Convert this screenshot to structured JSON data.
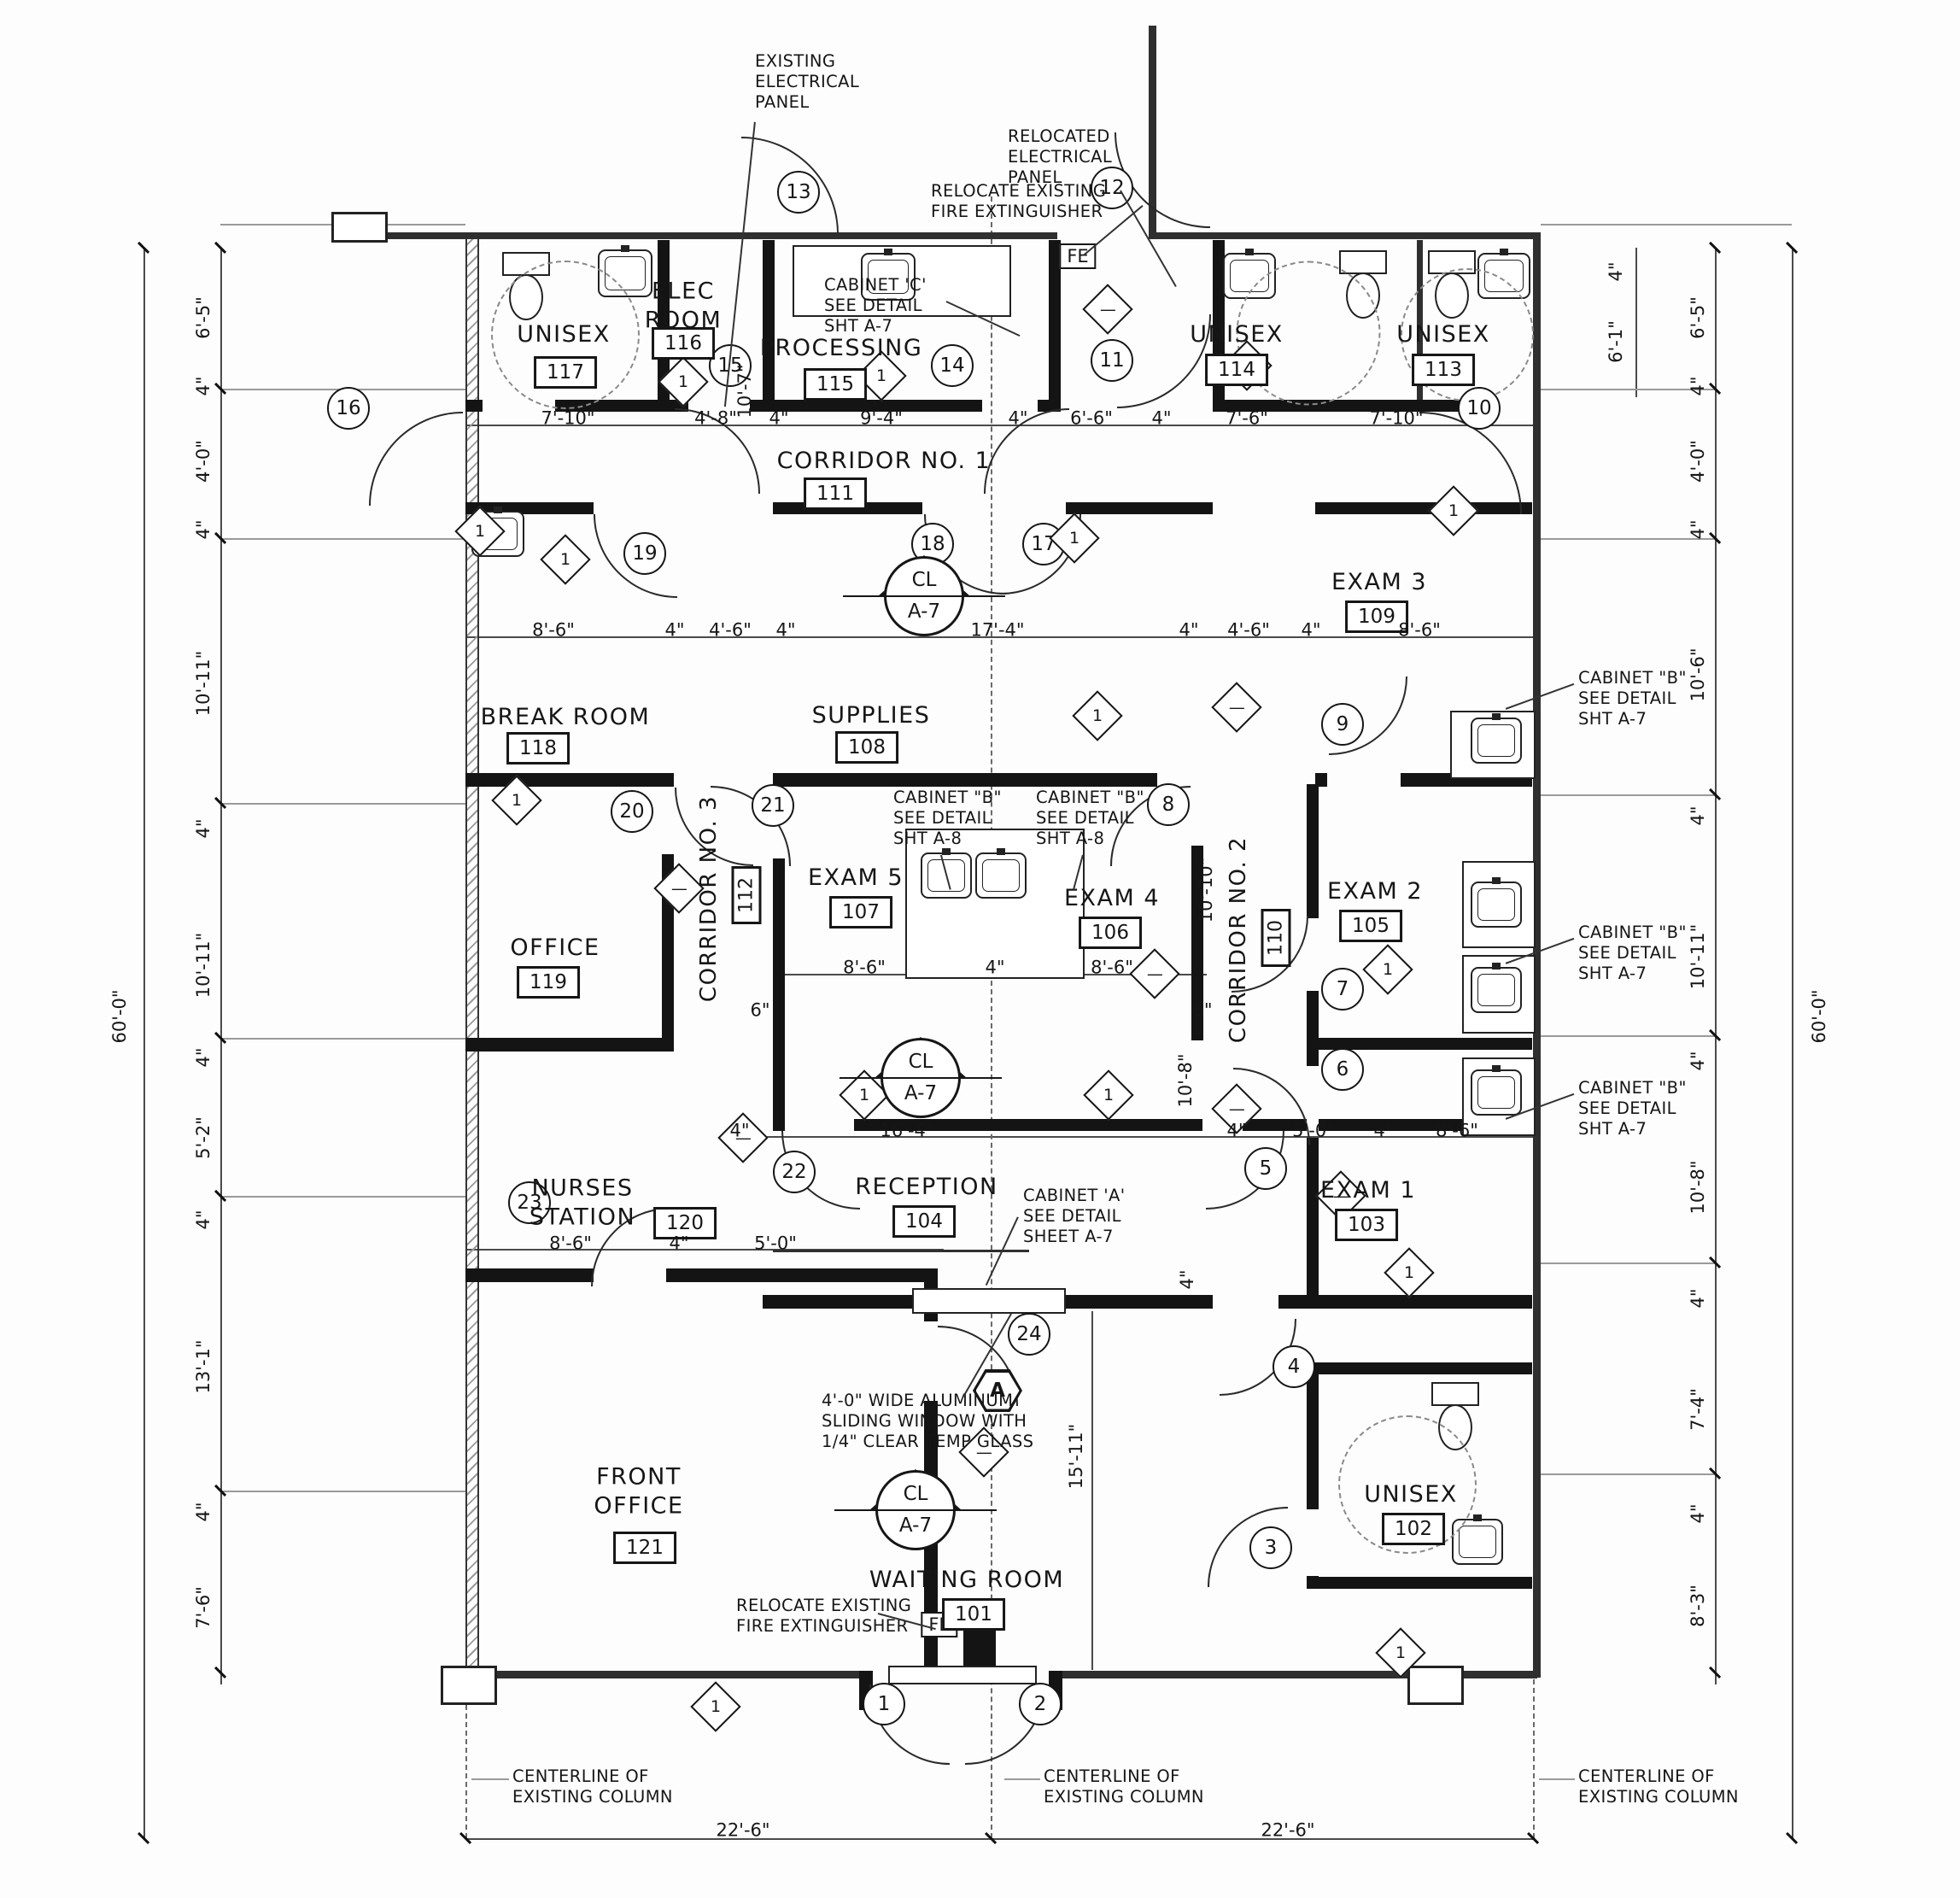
{
  "d": {
    "rooms": [
      {
        "name": "UNISEX",
        "number": "117"
      },
      {
        "name": "ELEC\nROOM",
        "number": "116"
      },
      {
        "name": "PROCESSING",
        "number": "115"
      },
      {
        "name": "UNISEX",
        "number": "114"
      },
      {
        "name": "UNISEX",
        "number": "113"
      },
      {
        "name": "CORRIDOR NO. 1",
        "number": "111"
      },
      {
        "name": "BREAK ROOM",
        "number": "118"
      },
      {
        "name": "SUPPLIES",
        "number": "108"
      },
      {
        "name": "EXAM 3",
        "number": "109"
      },
      {
        "name": "CORRIDOR NO. 3",
        "number": "112"
      },
      {
        "name": "EXAM 5",
        "number": "107"
      },
      {
        "name": "EXAM 4",
        "number": "106"
      },
      {
        "name": "CORRIDOR NO. 2",
        "number": "110"
      },
      {
        "name": "EXAM 2",
        "number": "105"
      },
      {
        "name": "OFFICE",
        "number": "119"
      },
      {
        "name": "NURSES\nSTATION",
        "number": "120"
      },
      {
        "name": "RECEPTION",
        "number": "104"
      },
      {
        "name": "EXAM 1",
        "number": "103"
      },
      {
        "name": "FRONT\nOFFICE",
        "number": "121"
      },
      {
        "name": "WAITING ROOM",
        "number": "101"
      },
      {
        "name": "UNISEX",
        "number": "102"
      }
    ],
    "doors": [
      "1",
      "2",
      "3",
      "4",
      "5",
      "6",
      "7",
      "8",
      "9",
      "10",
      "11",
      "12",
      "13",
      "14",
      "15",
      "16",
      "17",
      "18",
      "19",
      "20",
      "21",
      "22",
      "23",
      "24"
    ],
    "markers": {
      "cl": "CL",
      "cl_sheet": "A-7",
      "window_tag": "A",
      "fire_extinguisher": "FE",
      "keynote_bar": "1",
      "keynote_dash": "—"
    },
    "notes": {
      "existing_panel": "EXISTING\nELECTRICAL\nPANEL",
      "relocated_panel": "RELOCATED\nELECTRICAL\nPANEL",
      "relocate_fe_top": "RELOCATE EXISTING\nFIRE EXTINGUISHER",
      "cabinet_c": "CABINET 'C'\nSEE DETAIL\nSHT A-7",
      "cabinet_b_a8": "CABINET \"B\"\nSEE DETAIL\nSHT A-8",
      "cabinet_b_a7": "CABINET \"B\"\nSEE DETAIL\nSHT A-7",
      "cabinet_a": "CABINET 'A'\nSEE DETAIL\nSHEET A-7",
      "sliding_window": "4'-0\" WIDE ALUMINUM\nSLIDING WINDOW WITH\n1/4\" CLEAR TEMP GLASS",
      "relocate_fe_bottom": "RELOCATE EXISTING\nFIRE EXTINGUISHER",
      "centerline": "CENTERLINE OF\nEXISTING COLUMN"
    },
    "dims": {
      "top_row": [
        "7'-10\"",
        "4'-8\"",
        "4\"",
        "9'-4\"",
        "4\"",
        "6'-6\"",
        "4\"",
        "7'-6\"",
        "7'-10\""
      ],
      "mid_row": [
        "8'-6\"",
        "4\"",
        "4'-6\"",
        "4\"",
        "17'-4\"",
        "4\"",
        "4'-6\"",
        "4\"",
        "8'-6\""
      ],
      "exam_row": [
        "8'-6\"",
        "4\"",
        "8'-6\""
      ],
      "six_inch": "6\"",
      "reception_row": [
        "4\"",
        "16'-4\"",
        "4\"",
        "5'-0\"",
        "4\"",
        "8'-6\""
      ],
      "nurses_row": [
        "8'-6\"",
        "4\"",
        "5'-0\""
      ],
      "bottom_row": [
        "22'-6\"",
        "22'-6\""
      ],
      "left_col": [
        "6'-5\"",
        "4\"",
        "4'-0\"",
        "4\"",
        "10'-11\"",
        "4\"",
        "10'-11\"",
        "4\"",
        "5'-2\"",
        "4\"",
        "13'-1\"",
        "4\"",
        "7'-6\""
      ],
      "right_col": [
        "6'-5\"",
        "4\"",
        "4'-0\"",
        "4\"",
        "10'-6\"",
        "4\"",
        "10'-11\"",
        "4\"",
        "10'-8\"",
        "4\"",
        "7'-4\"",
        "4\"",
        "8'-3\""
      ],
      "right_inner": [
        "4\"",
        "6'-1\""
      ],
      "overall": "60'-0\"",
      "v_supplies": "10'-7\"",
      "v_exam4": "10'-10\"",
      "v_reception": "10'-8\"",
      "v_reception_small": "4\"",
      "v_waiting": "15'-11\""
    }
  }
}
